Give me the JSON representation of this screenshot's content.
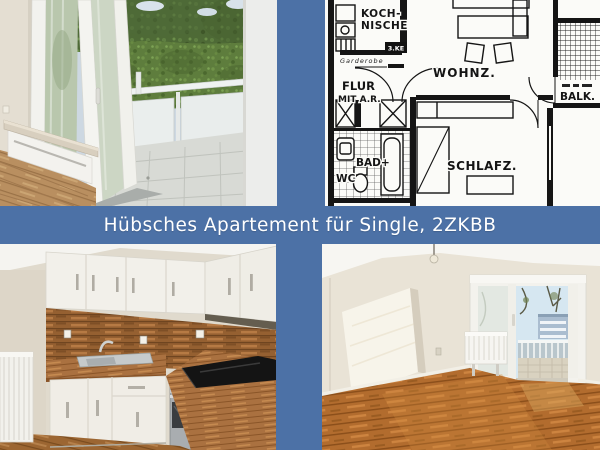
{
  "banner": {
    "title": "Hübsches Apartement für Single, 2ZKBB",
    "background_color": "#4c71a6",
    "text_color": "#ffffff"
  },
  "floor_plan": {
    "labels": {
      "kitchenette_line1": "KOCH-",
      "kitchenette_line2": "NISCHE",
      "wardrobe": "Garderobe",
      "fridge_box": "3.KE",
      "hall_line1": "FLUR",
      "hall_line2": "MIT A.R.",
      "living_room": "WOHNZ.",
      "balcony": "BALK.",
      "bath": "BAD+",
      "wc": "WC",
      "bedroom": "SCHLAFZ."
    }
  }
}
